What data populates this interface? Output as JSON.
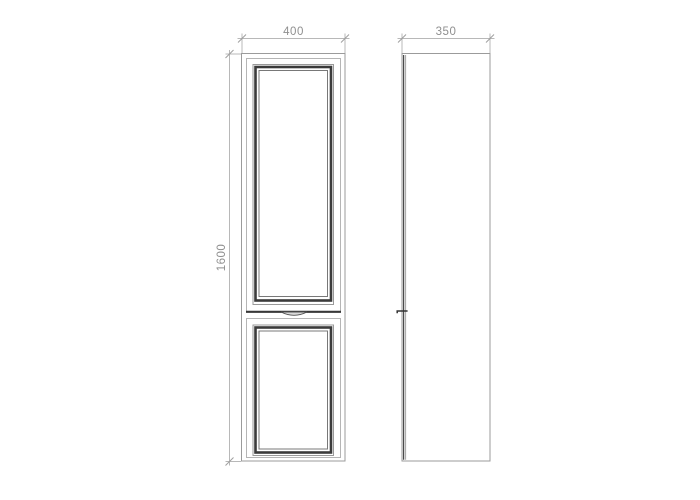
{
  "drawing": {
    "front_view": {
      "width_label": "400",
      "height_label": "1600"
    },
    "side_view": {
      "depth_label": "350"
    },
    "colors": {
      "background": "#ffffff",
      "carcass_outline": "#9b9b9b",
      "door_edge": "#b5b5b5",
      "molding_dark": "#3b3b3b",
      "molding_light": "#999999",
      "dimension_line": "#b8b8b8",
      "dimension_text": "#8f8f8f"
    }
  }
}
